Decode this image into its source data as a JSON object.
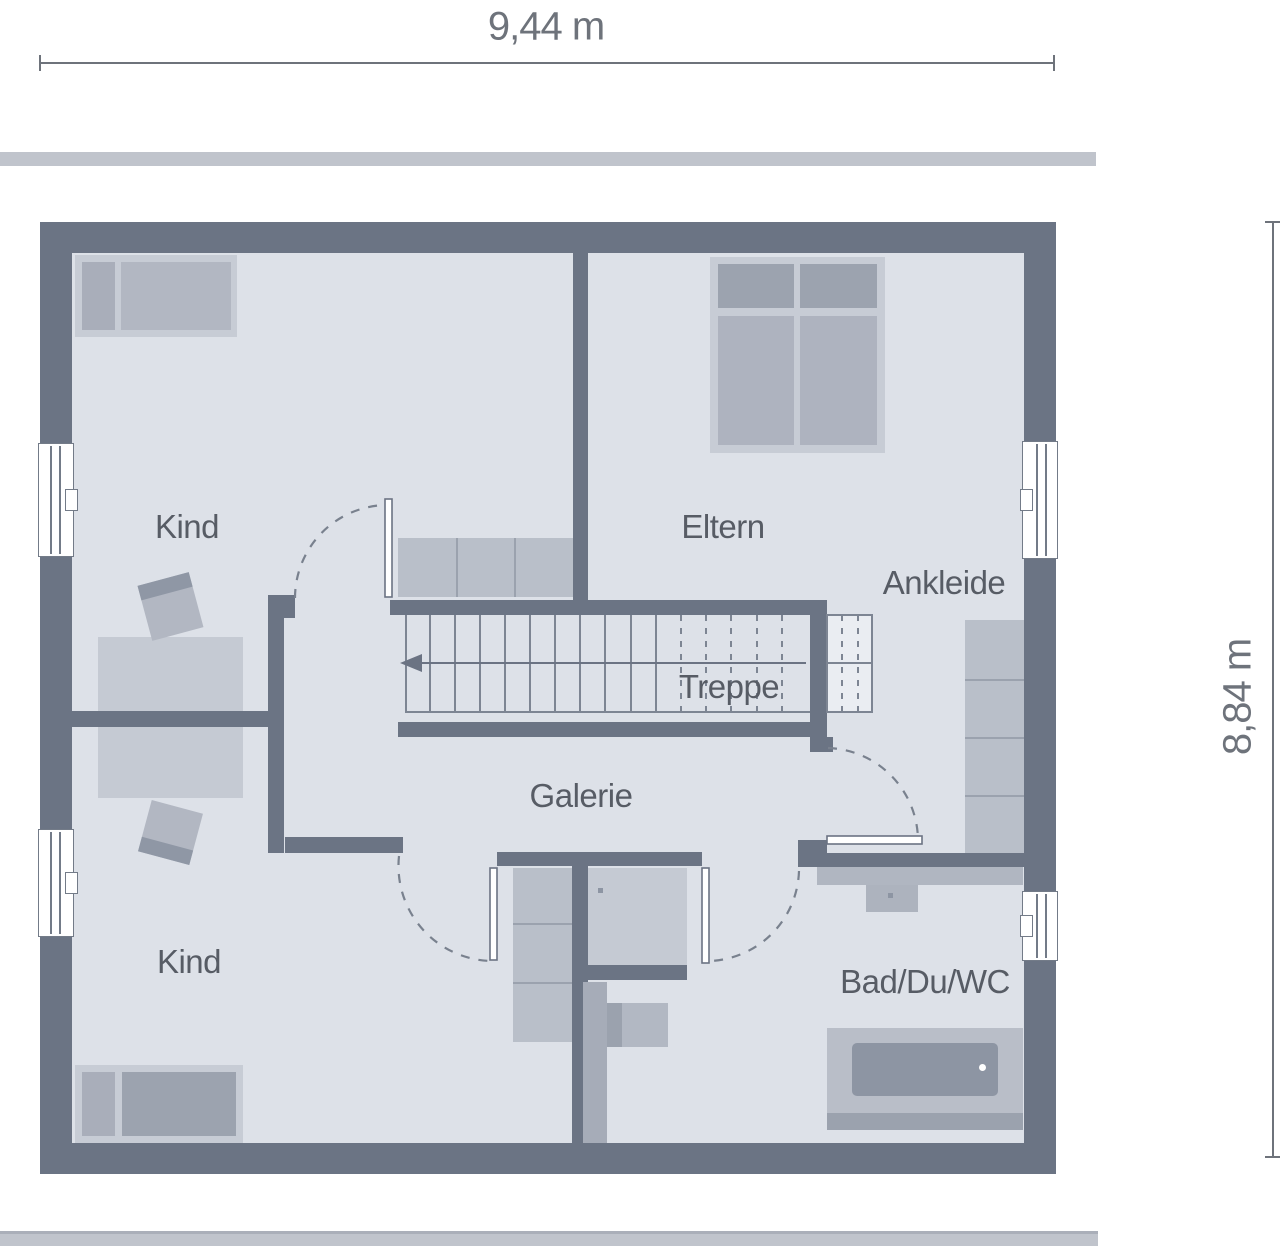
{
  "dimensions": {
    "width_label": "9,44 m",
    "height_label": "8,84 m"
  },
  "rooms": [
    {
      "id": "kind-upper",
      "label": "Kind"
    },
    {
      "id": "eltern",
      "label": "Eltern"
    },
    {
      "id": "ankleide",
      "label": "Ankleide"
    },
    {
      "id": "treppe",
      "label": "Treppe"
    },
    {
      "id": "galerie",
      "label": "Galerie"
    },
    {
      "id": "kind-lower",
      "label": "Kind"
    },
    {
      "id": "bad",
      "label": "Bad/Du/WC"
    }
  ],
  "stairs": {
    "direction_arrow": "left",
    "tread_count": 16
  },
  "colors": {
    "wall": "#6b7484",
    "floor": "#dde1e8",
    "furniture_light": "#c7ccd5",
    "furniture_dark": "#9ca3af",
    "line": "#79818e",
    "label_text": "#575c65",
    "dimension_text": "#6e737b",
    "roof_edge": "#c0c4cc"
  }
}
